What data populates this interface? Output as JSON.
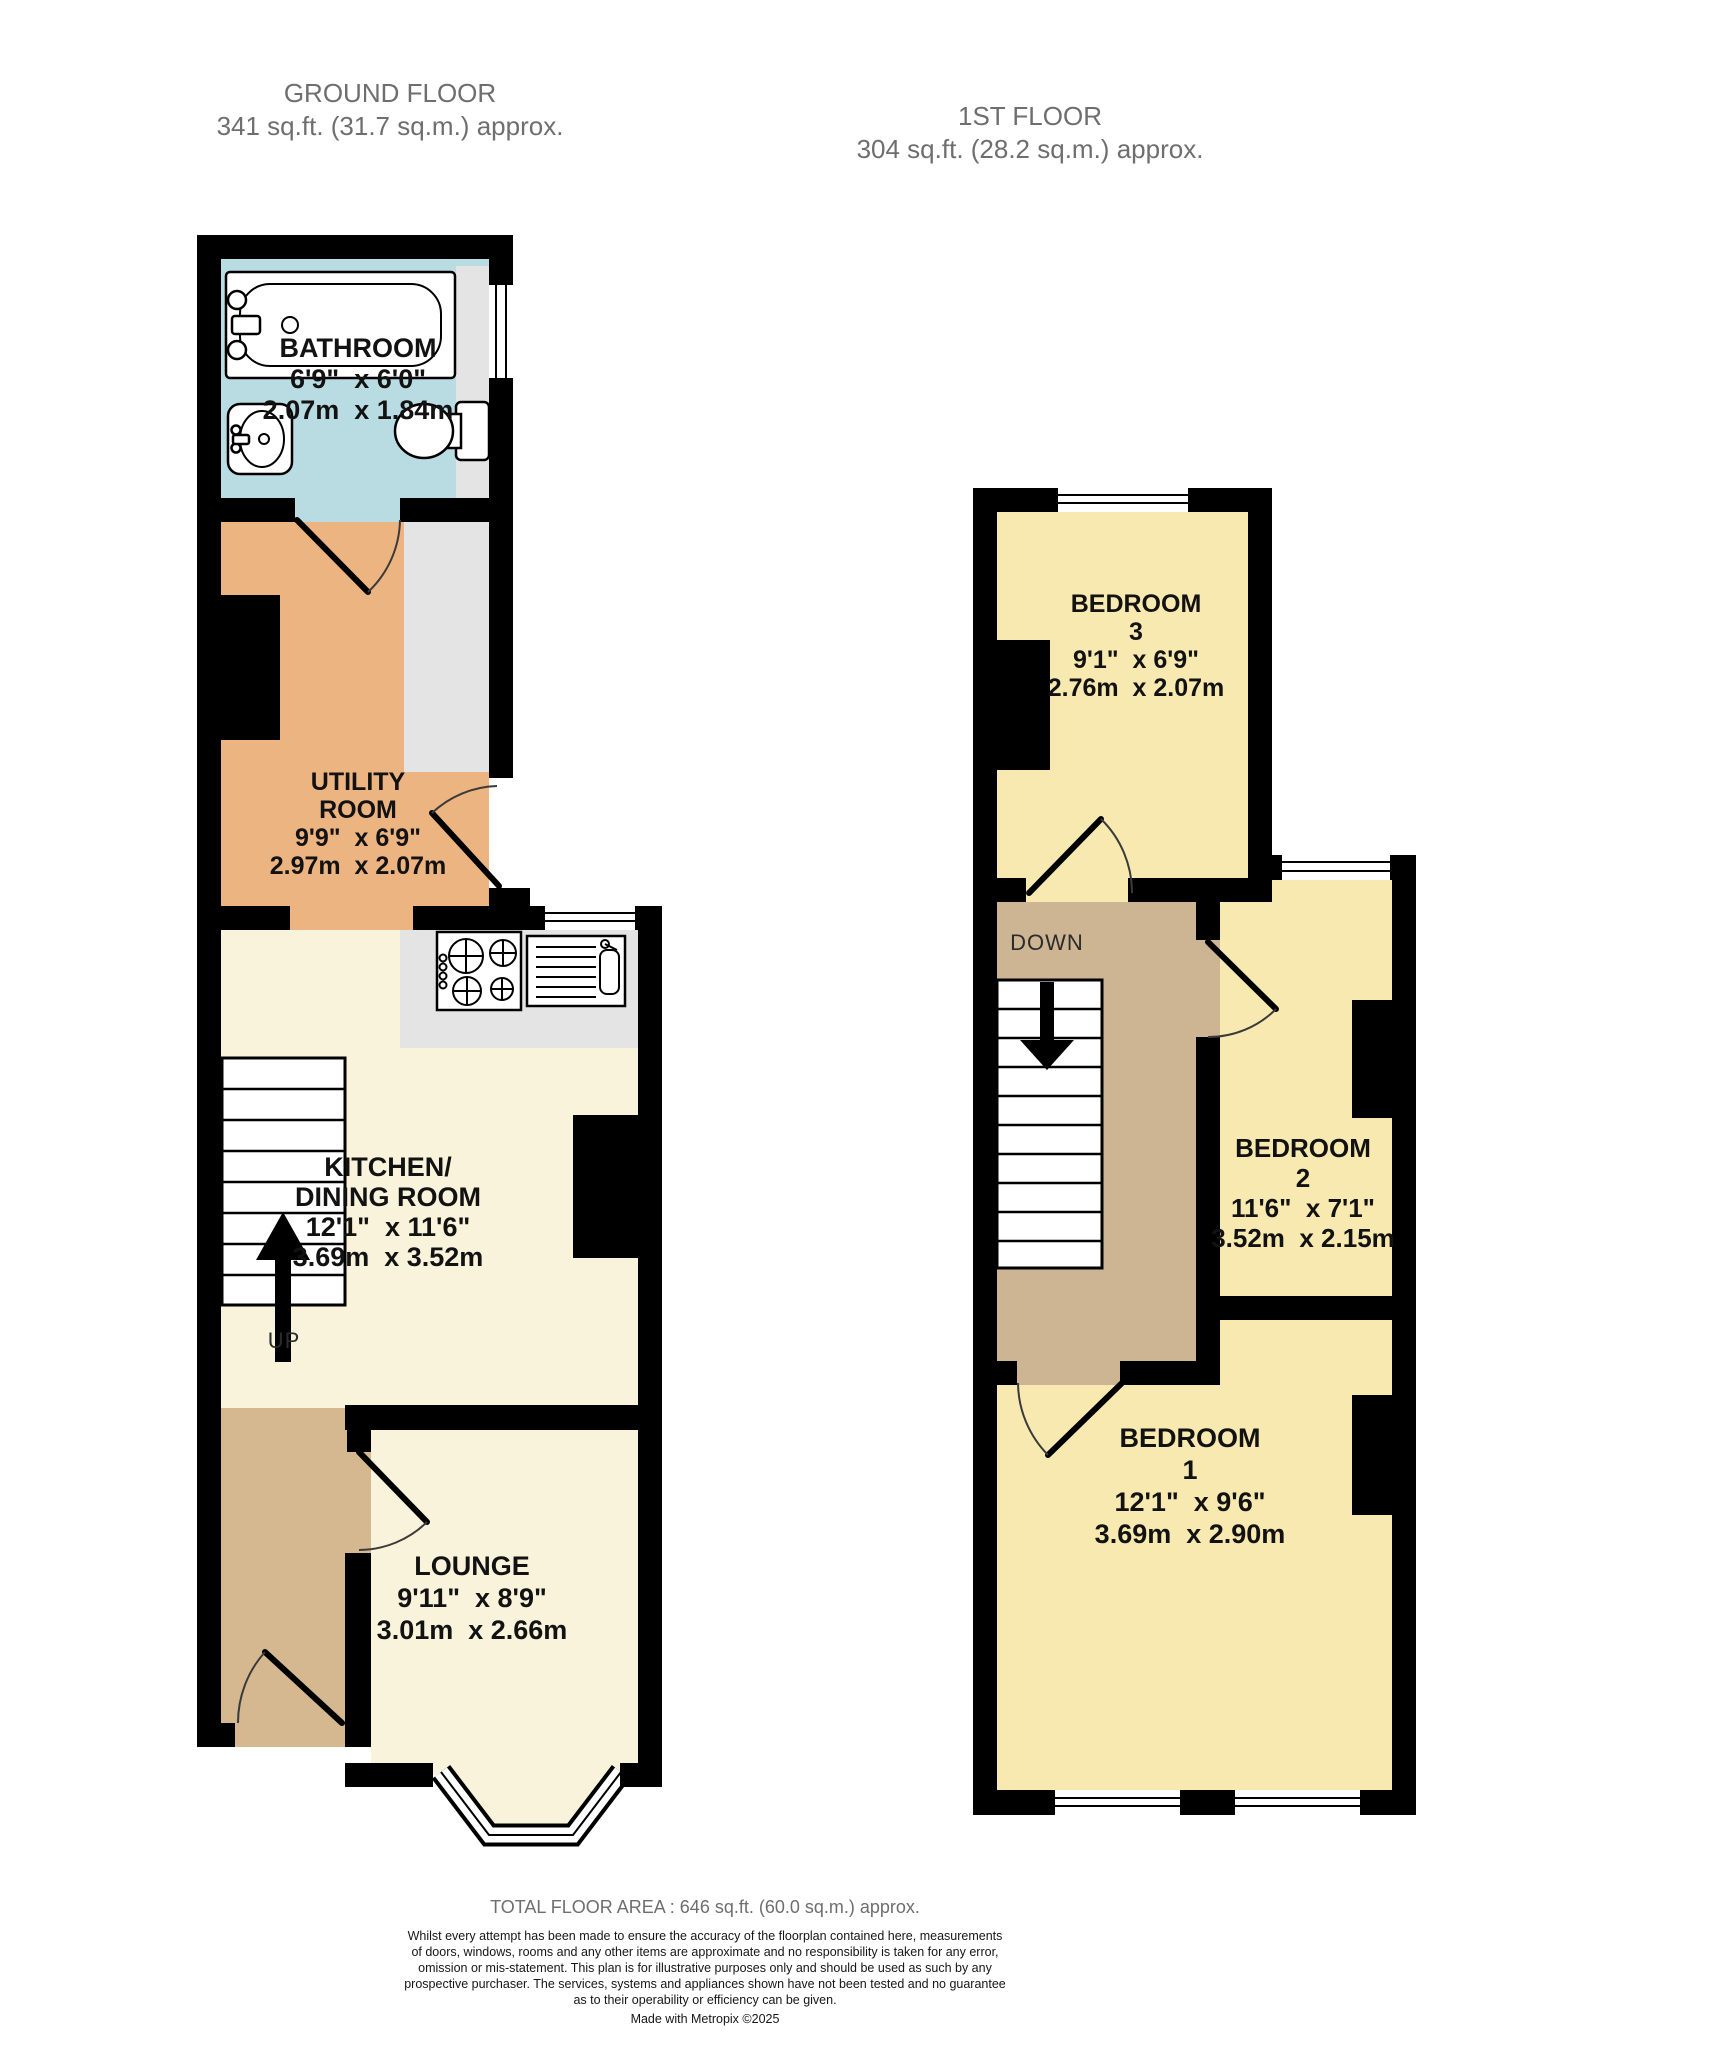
{
  "floors": {
    "ground": {
      "title": "GROUND FLOOR",
      "area": "341 sq.ft. (31.7 sq.m.) approx.",
      "stairs_label": "UP",
      "rooms": {
        "bathroom": {
          "name": "BATHROOM",
          "imperial": "6'9\"  x 6'0\"",
          "metric": "2.07m  x 1.84m"
        },
        "utility": {
          "name_lines": [
            "UTILITY",
            "ROOM"
          ],
          "imperial": "9'9\"  x 6'9\"",
          "metric": "2.97m  x 2.07m"
        },
        "kitchen": {
          "name_lines": [
            "KITCHEN/",
            "DINING ROOM"
          ],
          "imperial": "12'1\"  x 11'6\"",
          "metric": "3.69m  x 3.52m"
        },
        "lounge": {
          "name": "LOUNGE",
          "imperial": "9'11\"  x 8'9\"",
          "metric": "3.01m  x 2.66m"
        }
      }
    },
    "first": {
      "title": "1ST FLOOR",
      "area": "304 sq.ft. (28.2 sq.m.) approx.",
      "stairs_label": "DOWN",
      "rooms": {
        "bedroom3": {
          "name": "BEDROOM",
          "number": "3",
          "imperial": "9'1\"  x 6'9\"",
          "metric": "2.76m  x 2.07m"
        },
        "bedroom2": {
          "name": "BEDROOM",
          "number": "2",
          "imperial": "11'6\"  x 7'1\"",
          "metric": "3.52m  x 2.15m"
        },
        "bedroom1": {
          "name": "BEDROOM",
          "number": "1",
          "imperial": "12'1\"  x 9'6\"",
          "metric": "3.69m  x 2.90m"
        }
      }
    }
  },
  "footer": {
    "total_area": "TOTAL FLOOR AREA : 646 sq.ft. (60.0 sq.m.) approx.",
    "disclaimer_lines": [
      "Whilst every attempt has been made to ensure the accuracy of the floorplan contained here, measurements",
      "of doors, windows, rooms and any other items are approximate and no responsibility is taken for any error,",
      "omission or mis-statement. This plan is for illustrative purposes only and should be used as such by any",
      "prospective purchaser. The services, systems and appliances shown have not been tested and no guarantee",
      "as to their operability or efficiency can be given."
    ],
    "credit": "Made with Metropix ©2025"
  },
  "colors": {
    "wall": "#000000",
    "bathroom": "#b9dce3",
    "utility": "#ecb480",
    "cream": "#f8f3da",
    "hall": "#d5b88f",
    "landing": "#cdb493",
    "bedroom": "#f7e9af",
    "appliance_grey": "#e4e4e4",
    "title": "#6e6e6e",
    "label": "#121212"
  }
}
